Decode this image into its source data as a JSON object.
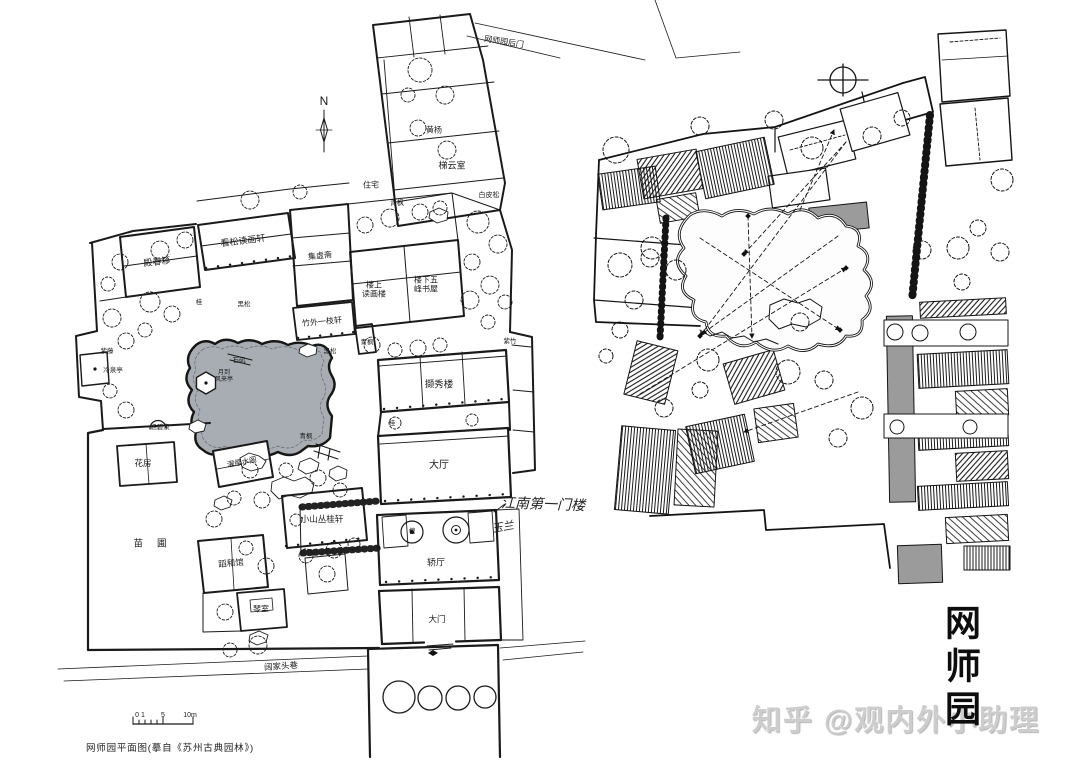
{
  "colors": {
    "ink": "#1a1a1a",
    "pond": "#a7adb3",
    "corridor_gray": "#9b9b9b",
    "watermark": "#cdcdcd"
  },
  "title": {
    "text": "网师园"
  },
  "watermark": {
    "text": "知乎 @观内外小助理"
  },
  "left_plan": {
    "caption": "网师园平面图(摹自《苏州古典园林》)",
    "north_label": "N",
    "scalebar": {
      "left": "0 1",
      "mid": "5",
      "right": "10m"
    },
    "handwritten": {
      "gatehouse": "江南第一门楼",
      "magnolia": "玉兰"
    },
    "labels": {
      "back_gate": "网师园后门",
      "residence": "住宅",
      "boxwood": "黄杨",
      "tiyun_room": "梯云室",
      "white_pine": "白皮松",
      "maple_nw": "青枫",
      "dianchun_studio": "殿春簃",
      "kansong_xuan": "看松读画轩",
      "jixu_studio": "集虚斋",
      "duhua_tower": "楼上\n读画楼",
      "wufeng_study": "楼下五\n峰书屋",
      "zhuwai_xuan": "竹外一枝轩",
      "black_pine_w": "黑松",
      "osmanthus_n": "桂",
      "wisteria": "紫藤",
      "cold_spring_pav": "冷泉亭",
      "moon_wind_pav": "月到\n风来亭",
      "stone_jetty": "石矶",
      "black_pine_e": "黑松",
      "maple_mid": "青枫",
      "purple_bamboo": "紫竹",
      "hanbi_spring": "涵碧泉",
      "flower_house": "花房",
      "zhuoying_pav": "濯缨水阁",
      "maple_s": "青枫",
      "xiexiu_tower": "撷秀楼",
      "osmanthus_s": "桂",
      "main_hall": "大厅",
      "xiaoshan_xuan": "小山丛桂轩",
      "nursery": "苗圃",
      "daohe_hall": "蹈和馆",
      "qin_room": "琴室",
      "sedan_hall": "轿厅",
      "pagoda_tree": "槐",
      "main_gate": "大门",
      "street": "阔家头巷"
    }
  }
}
